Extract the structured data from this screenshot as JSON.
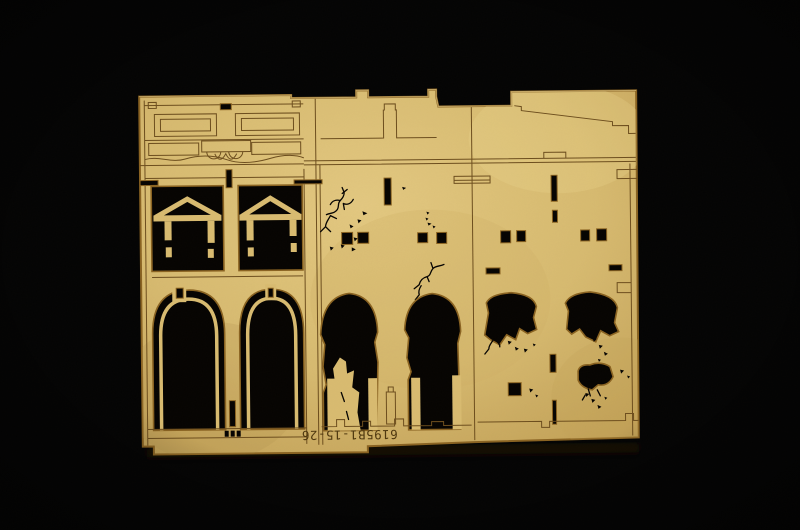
{
  "photo": {
    "subject": "Laser-cut tan hardboard model kit sheet with three ruined building facade sections, photographed on a black background",
    "background_color": "#040404"
  },
  "sheet": {
    "part_number": "6195B1-15-26",
    "part_number_display": "rotated-180-degrees",
    "material_color": "#d8bb70",
    "material_edge_color": "#8a6322",
    "etched_line_color": "#6d4e1e",
    "cutout_color": "#060402",
    "bays": [
      {
        "label": "ornate storefront bay with pedimented windows and twin arched doorways"
      },
      {
        "label": "cracked facade bay with two broken arched openings"
      },
      {
        "label": "ruined bay with collapsed sloped roofline and shell damage"
      }
    ]
  }
}
